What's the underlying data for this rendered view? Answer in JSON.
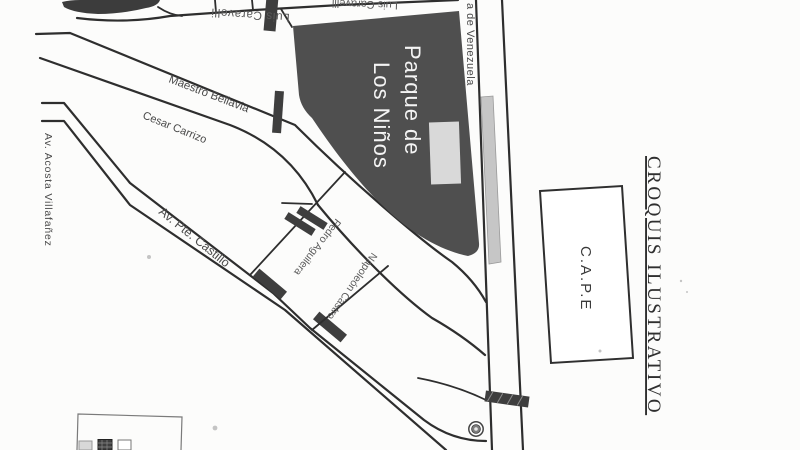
{
  "title": "CROQUIS ILUSTRATIVO",
  "colors": {
    "background": "#fcfcfb",
    "ink": "#2e2e2e",
    "label_ink": "#4a4a4a",
    "park_fill": "#4f4f4f",
    "park_text": "#f4f4f4",
    "marker_fill": "#3e3e3e",
    "median_fill": "#c6c6c6",
    "building_fill": "#d9d9d9",
    "blob_fill": "#3c3c3c"
  },
  "map": {
    "park": {
      "line1": "Parque de",
      "line2": "Los Niños"
    },
    "streets": {
      "luis_caravelli": "Luis Caravelli",
      "maestro_bellavia": "Maestro Bellavia",
      "cesar_carrizo": "Cesar Carrizo",
      "acosta_villafanez": "Av. Acosta Villafañez",
      "pte_castillo": "Av. Pte. Castillo",
      "pedro_aguilera": "Pedro Aguilera",
      "napoleon_castro": "Napoleón Castro",
      "venezuela_visible": "a de Venezuela"
    },
    "landmarks": {
      "cape": "C.A.P.E"
    }
  }
}
